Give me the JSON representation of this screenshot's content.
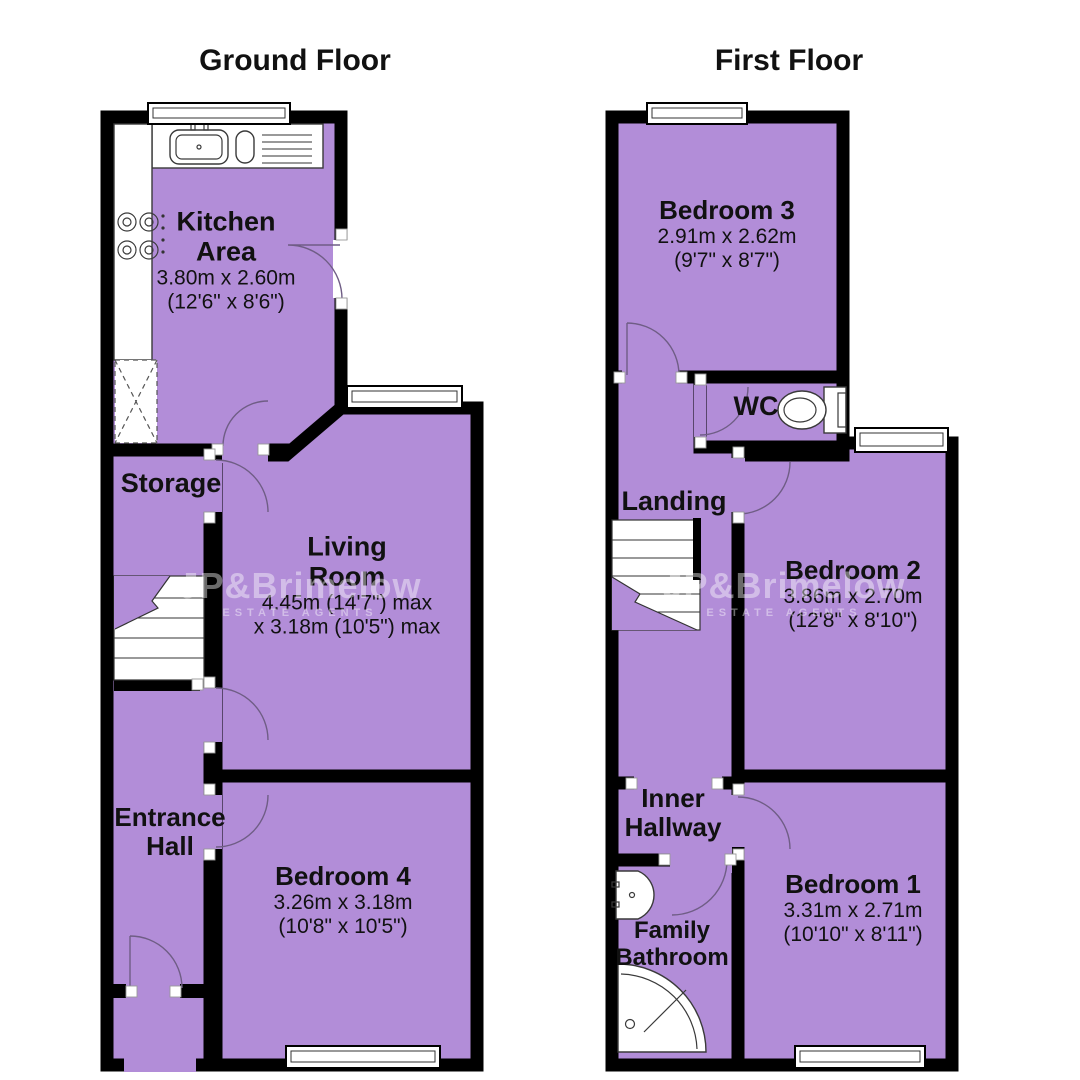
{
  "colors": {
    "room_fill": "#b28dd8",
    "wall": "#000000",
    "door_arc": "#6f5d85"
  },
  "watermark": {
    "brand": "JP&Brimelow",
    "tagline": "ESTATE AGENTS"
  },
  "ground_floor": {
    "title": "Ground Floor",
    "kitchen": {
      "name_line1": "Kitchen",
      "name_line2": "Area",
      "metric": "3.80m x 2.60m",
      "imperial": "(12'6\" x 8'6\")"
    },
    "storage": {
      "name": "Storage"
    },
    "living_room": {
      "name_line1": "Living",
      "name_line2": "Room",
      "metric": "4.45m (14'7\") max",
      "imperial": "x 3.18m (10'5\") max"
    },
    "entrance_hall": {
      "name_line1": "Entrance",
      "name_line2": "Hall"
    },
    "bedroom4": {
      "name": "Bedroom 4",
      "metric": "3.26m x 3.18m",
      "imperial": "(10'8\" x 10'5\")"
    }
  },
  "first_floor": {
    "title": "First Floor",
    "bedroom3": {
      "name": "Bedroom 3",
      "metric": "2.91m x 2.62m",
      "imperial": "(9'7\" x 8'7\")"
    },
    "wc": {
      "name": "WC"
    },
    "landing": {
      "name": "Landing"
    },
    "bedroom2": {
      "name": "Bedroom 2",
      "metric": "3.86m x 2.70m",
      "imperial": "(12'8\" x 8'10\")"
    },
    "inner_hallway": {
      "name_line1": "Inner",
      "name_line2": "Hallway"
    },
    "family_bathroom": {
      "name_line1": "Family",
      "name_line2": "Bathroom"
    },
    "bedroom1": {
      "name": "Bedroom 1",
      "metric": "3.31m x 2.71m",
      "imperial": "(10'10\" x 8'11\")"
    }
  }
}
